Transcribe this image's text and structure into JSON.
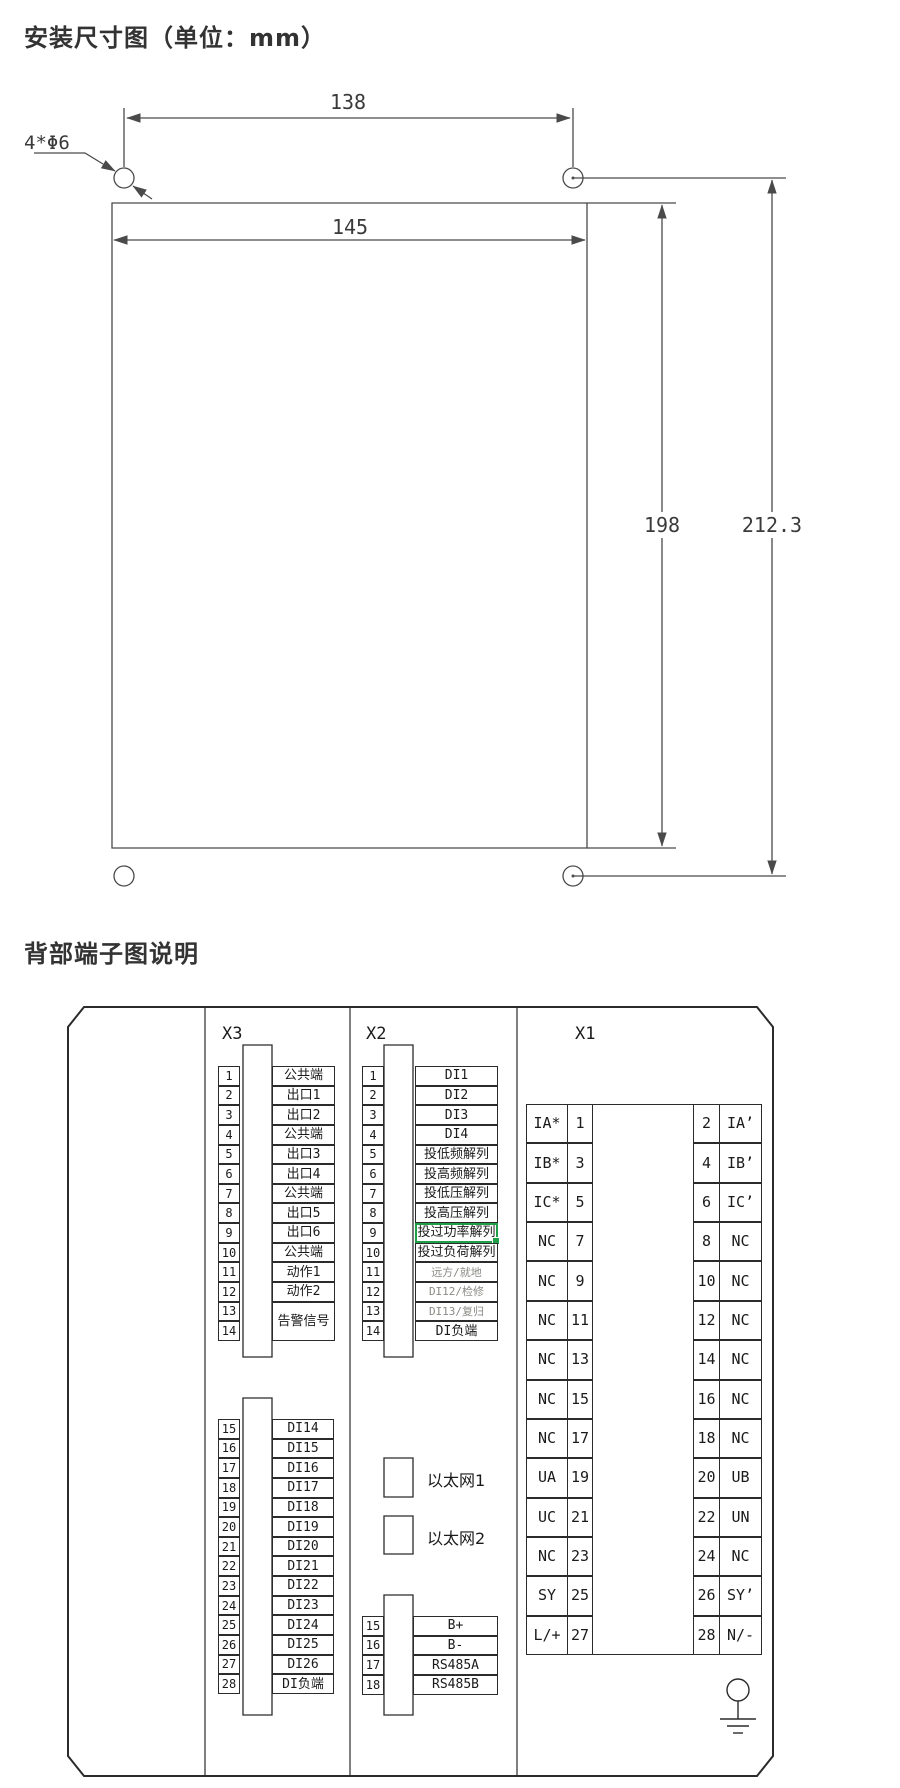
{
  "install_section": {
    "title": "安装尺寸图（单位：mm）",
    "hole_label": "4*Φ6",
    "dims": {
      "hole_spacing": "138",
      "cutout_width": "145",
      "cutout_height": "198",
      "overall_height": "212.3"
    }
  },
  "terminal_section": {
    "title": "背部端子图说明",
    "headers": {
      "x3": "X3",
      "x2": "X2",
      "x1": "X1"
    },
    "x3_upper": [
      {
        "num": "1",
        "label": "公共端"
      },
      {
        "num": "2",
        "label": "出口1"
      },
      {
        "num": "3",
        "label": "出口2"
      },
      {
        "num": "4",
        "label": "公共端"
      },
      {
        "num": "5",
        "label": "出口3"
      },
      {
        "num": "6",
        "label": "出口4"
      },
      {
        "num": "7",
        "label": "公共端"
      },
      {
        "num": "8",
        "label": "出口5"
      },
      {
        "num": "9",
        "label": "出口6"
      },
      {
        "num": "10",
        "label": "公共端"
      },
      {
        "num": "11",
        "label": "动作1"
      },
      {
        "num": "12",
        "label": "动作2"
      },
      {
        "num": "13",
        "label": "告警信号",
        "span": 2
      },
      {
        "num": "14",
        "label": ""
      }
    ],
    "x3_lower": [
      {
        "num": "15",
        "label": "DI14"
      },
      {
        "num": "16",
        "label": "DI15"
      },
      {
        "num": "17",
        "label": "DI16"
      },
      {
        "num": "18",
        "label": "DI17"
      },
      {
        "num": "19",
        "label": "DI18"
      },
      {
        "num": "20",
        "label": "DI19"
      },
      {
        "num": "21",
        "label": "DI20"
      },
      {
        "num": "22",
        "label": "DI21"
      },
      {
        "num": "23",
        "label": "DI22"
      },
      {
        "num": "24",
        "label": "DI23"
      },
      {
        "num": "25",
        "label": "DI24"
      },
      {
        "num": "26",
        "label": "DI25"
      },
      {
        "num": "27",
        "label": "DI26"
      },
      {
        "num": "28",
        "label": "DI负端"
      }
    ],
    "x2_upper": [
      {
        "num": "1",
        "label": "DI1"
      },
      {
        "num": "2",
        "label": "DI2"
      },
      {
        "num": "3",
        "label": "DI3"
      },
      {
        "num": "4",
        "label": "DI4"
      },
      {
        "num": "5",
        "label": "投低频解列"
      },
      {
        "num": "6",
        "label": "投高频解列"
      },
      {
        "num": "7",
        "label": "投低压解列"
      },
      {
        "num": "8",
        "label": "投高压解列"
      },
      {
        "num": "9",
        "label": "投过功率解列",
        "selected": true
      },
      {
        "num": "10",
        "label": "投过负荷解列"
      },
      {
        "num": "11",
        "label": "远方/就地",
        "muted": true
      },
      {
        "num": "12",
        "label": "DI12/检修",
        "muted": true
      },
      {
        "num": "13",
        "label": "DI13/复归",
        "muted": true
      },
      {
        "num": "14",
        "label": "DI负端"
      }
    ],
    "ethernet": [
      {
        "label": "以太网1"
      },
      {
        "label": "以太网2"
      }
    ],
    "x2_lower": [
      {
        "num": "15",
        "label": "B+"
      },
      {
        "num": "16",
        "label": "B-"
      },
      {
        "num": "17",
        "label": "RS485A"
      },
      {
        "num": "18",
        "label": "RS485B"
      }
    ],
    "x1_rows": [
      {
        "l": "IA*",
        "ln": "1",
        "rn": "2",
        "r": "IA’"
      },
      {
        "l": "IB*",
        "ln": "3",
        "rn": "4",
        "r": "IB’"
      },
      {
        "l": "IC*",
        "ln": "5",
        "rn": "6",
        "r": "IC’"
      },
      {
        "l": "NC",
        "ln": "7",
        "rn": "8",
        "r": "NC"
      },
      {
        "l": "NC",
        "ln": "9",
        "rn": "10",
        "r": "NC"
      },
      {
        "l": "NC",
        "ln": "11",
        "rn": "12",
        "r": "NC"
      },
      {
        "l": "NC",
        "ln": "13",
        "rn": "14",
        "r": "NC"
      },
      {
        "l": "NC",
        "ln": "15",
        "rn": "16",
        "r": "NC"
      },
      {
        "l": "NC",
        "ln": "17",
        "rn": "18",
        "r": "NC"
      },
      {
        "l": "UA",
        "ln": "19",
        "rn": "20",
        "r": "UB"
      },
      {
        "l": "UC",
        "ln": "21",
        "rn": "22",
        "r": "UN"
      },
      {
        "l": "NC",
        "ln": "23",
        "rn": "24",
        "r": "NC"
      },
      {
        "l": "SY",
        "ln": "25",
        "rn": "26",
        "r": "SY’"
      },
      {
        "l": "L/+",
        "ln": "27",
        "rn": "28",
        "r": "N/-"
      }
    ],
    "colors": {
      "selection_green": "#1fa048",
      "muted_text": "#8a8a85",
      "line": "#2b2b2b",
      "dim_line": "#4a4a4a"
    }
  }
}
